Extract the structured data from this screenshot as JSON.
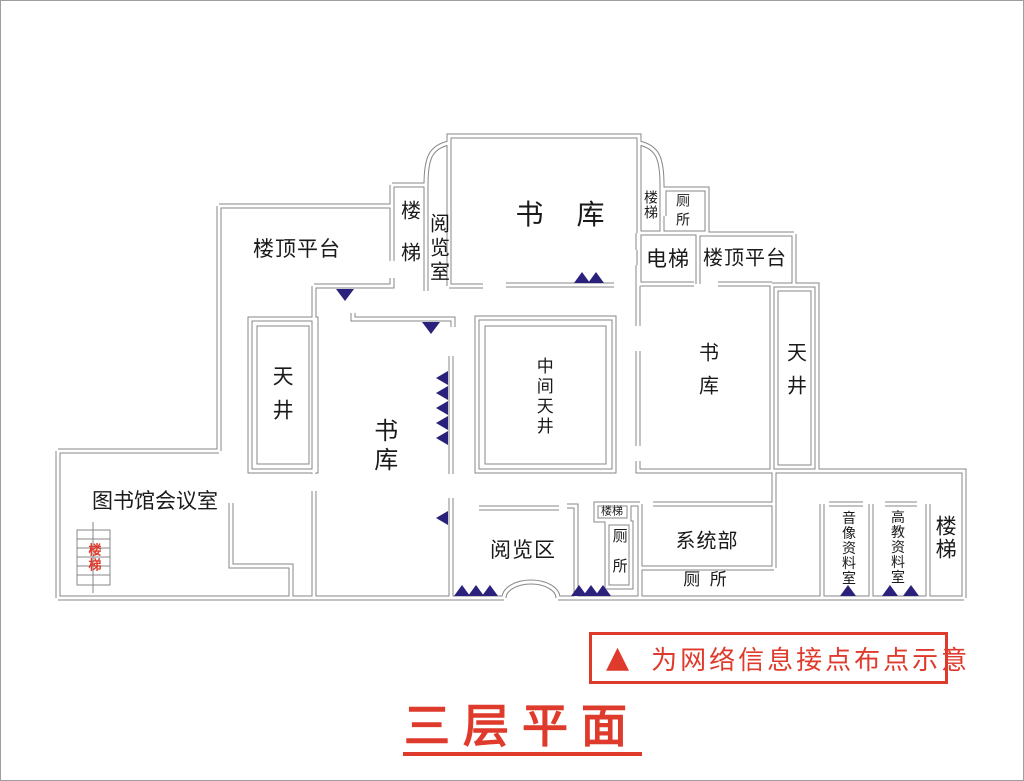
{
  "palette": {
    "wall": "#878787",
    "marker": "#29217b",
    "red": "#df3b2d",
    "ink": "#1a1a1a"
  },
  "title": {
    "text": "三层平面"
  },
  "legend": {
    "marker_icon": "▲",
    "text": "为网络信息接点布点示意"
  },
  "icons": {
    "network_point": "▲"
  },
  "rooms": {
    "stacks_top": "书 库",
    "roof_terrace_left": "楼顶平台",
    "stairs_top_mid": "楼梯",
    "reading_room_top": "阅览室",
    "stairs_top_right": "楼梯",
    "toilet_top_right": "厕所",
    "elevator": "电梯",
    "roof_terrace_right": "楼顶平台",
    "courtyard_left": "天井",
    "stacks_left": "书库",
    "courtyard_center": "中间天井",
    "stacks_right": "书库",
    "courtyard_right": "天井",
    "meeting_room": "图书馆会议室",
    "stairs_left_red": "楼梯",
    "reading_area": "阅览区",
    "stairs_center_small": "楼梯",
    "toilet_center": "厕所",
    "systems_dept": "系统部",
    "toilet_bottom": "厕 所",
    "av_archive": "音像资料室",
    "higher_ed_archive": "高教资料室",
    "stairs_bottom_right": "楼梯"
  }
}
